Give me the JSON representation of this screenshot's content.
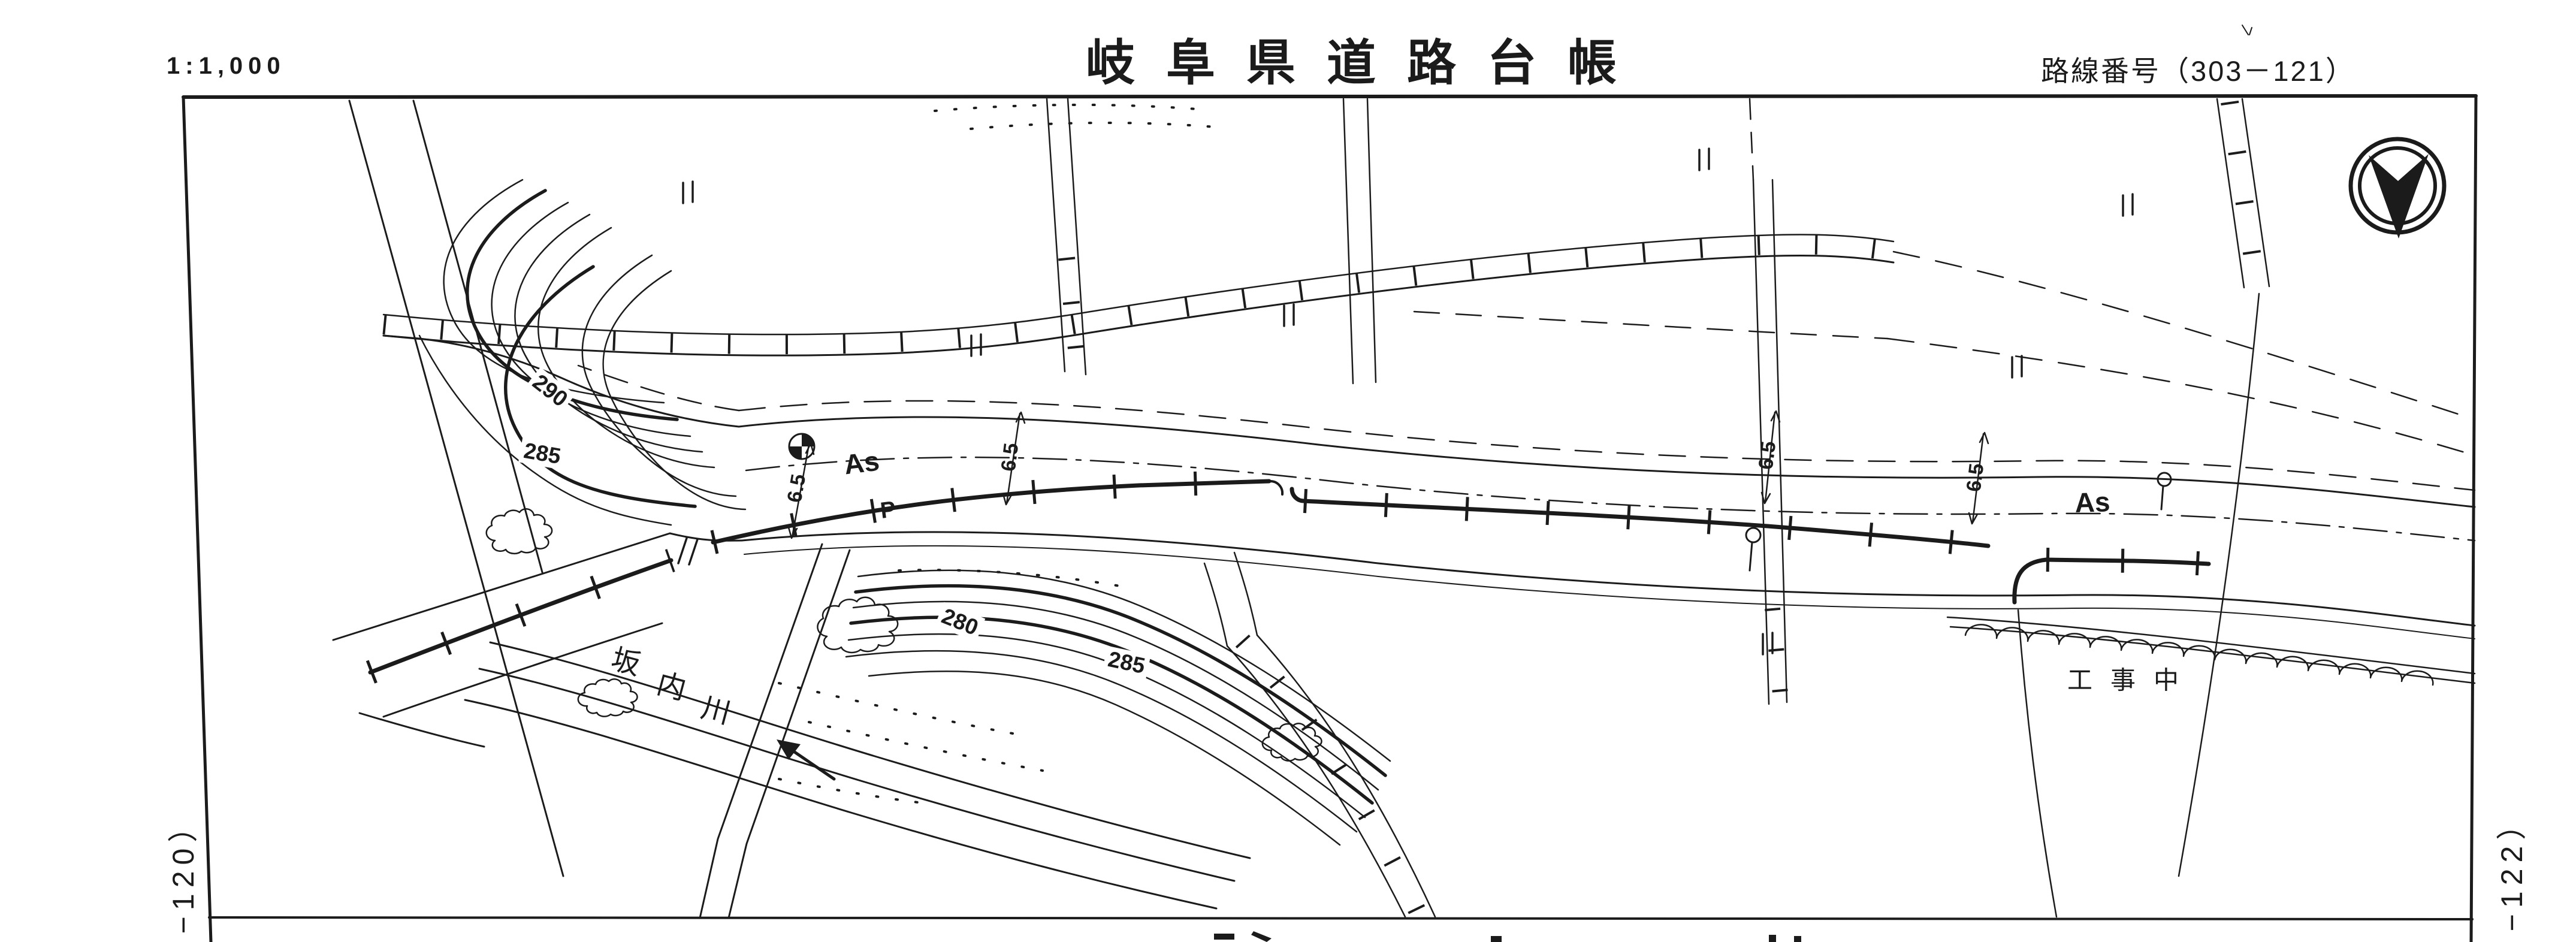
{
  "colors": {
    "ink": "#1b1b1b",
    "paper": "#ffffff"
  },
  "header": {
    "scale": "1:1,000",
    "title": "岐阜県道路台帳",
    "route_label": "路線番号（303－121）"
  },
  "sheet_refs": {
    "left": "−120）",
    "right": "−122）"
  },
  "map": {
    "surface_labels": {
      "as_left": "As",
      "as_right": "As",
      "p": "P"
    },
    "width_labels": {
      "w1": "6.5",
      "w2": "6.5",
      "w3": "6.5",
      "w4": "6.5"
    },
    "contour_labels": {
      "c290": "290",
      "c285_left": "285",
      "c280": "280",
      "c285_mid": "285"
    },
    "river_name": {
      "char1": "坂",
      "char2": "内",
      "char3": "川"
    },
    "construction_label": "工事中",
    "icons": {
      "north_arrow": "north-arrow-icon",
      "benchmark": "benchmark-icon",
      "utility_pole": "utility-pole-icon",
      "flow_arrow": "river-flow-arrow-icon",
      "paddy": "paddy-field-icon"
    }
  }
}
